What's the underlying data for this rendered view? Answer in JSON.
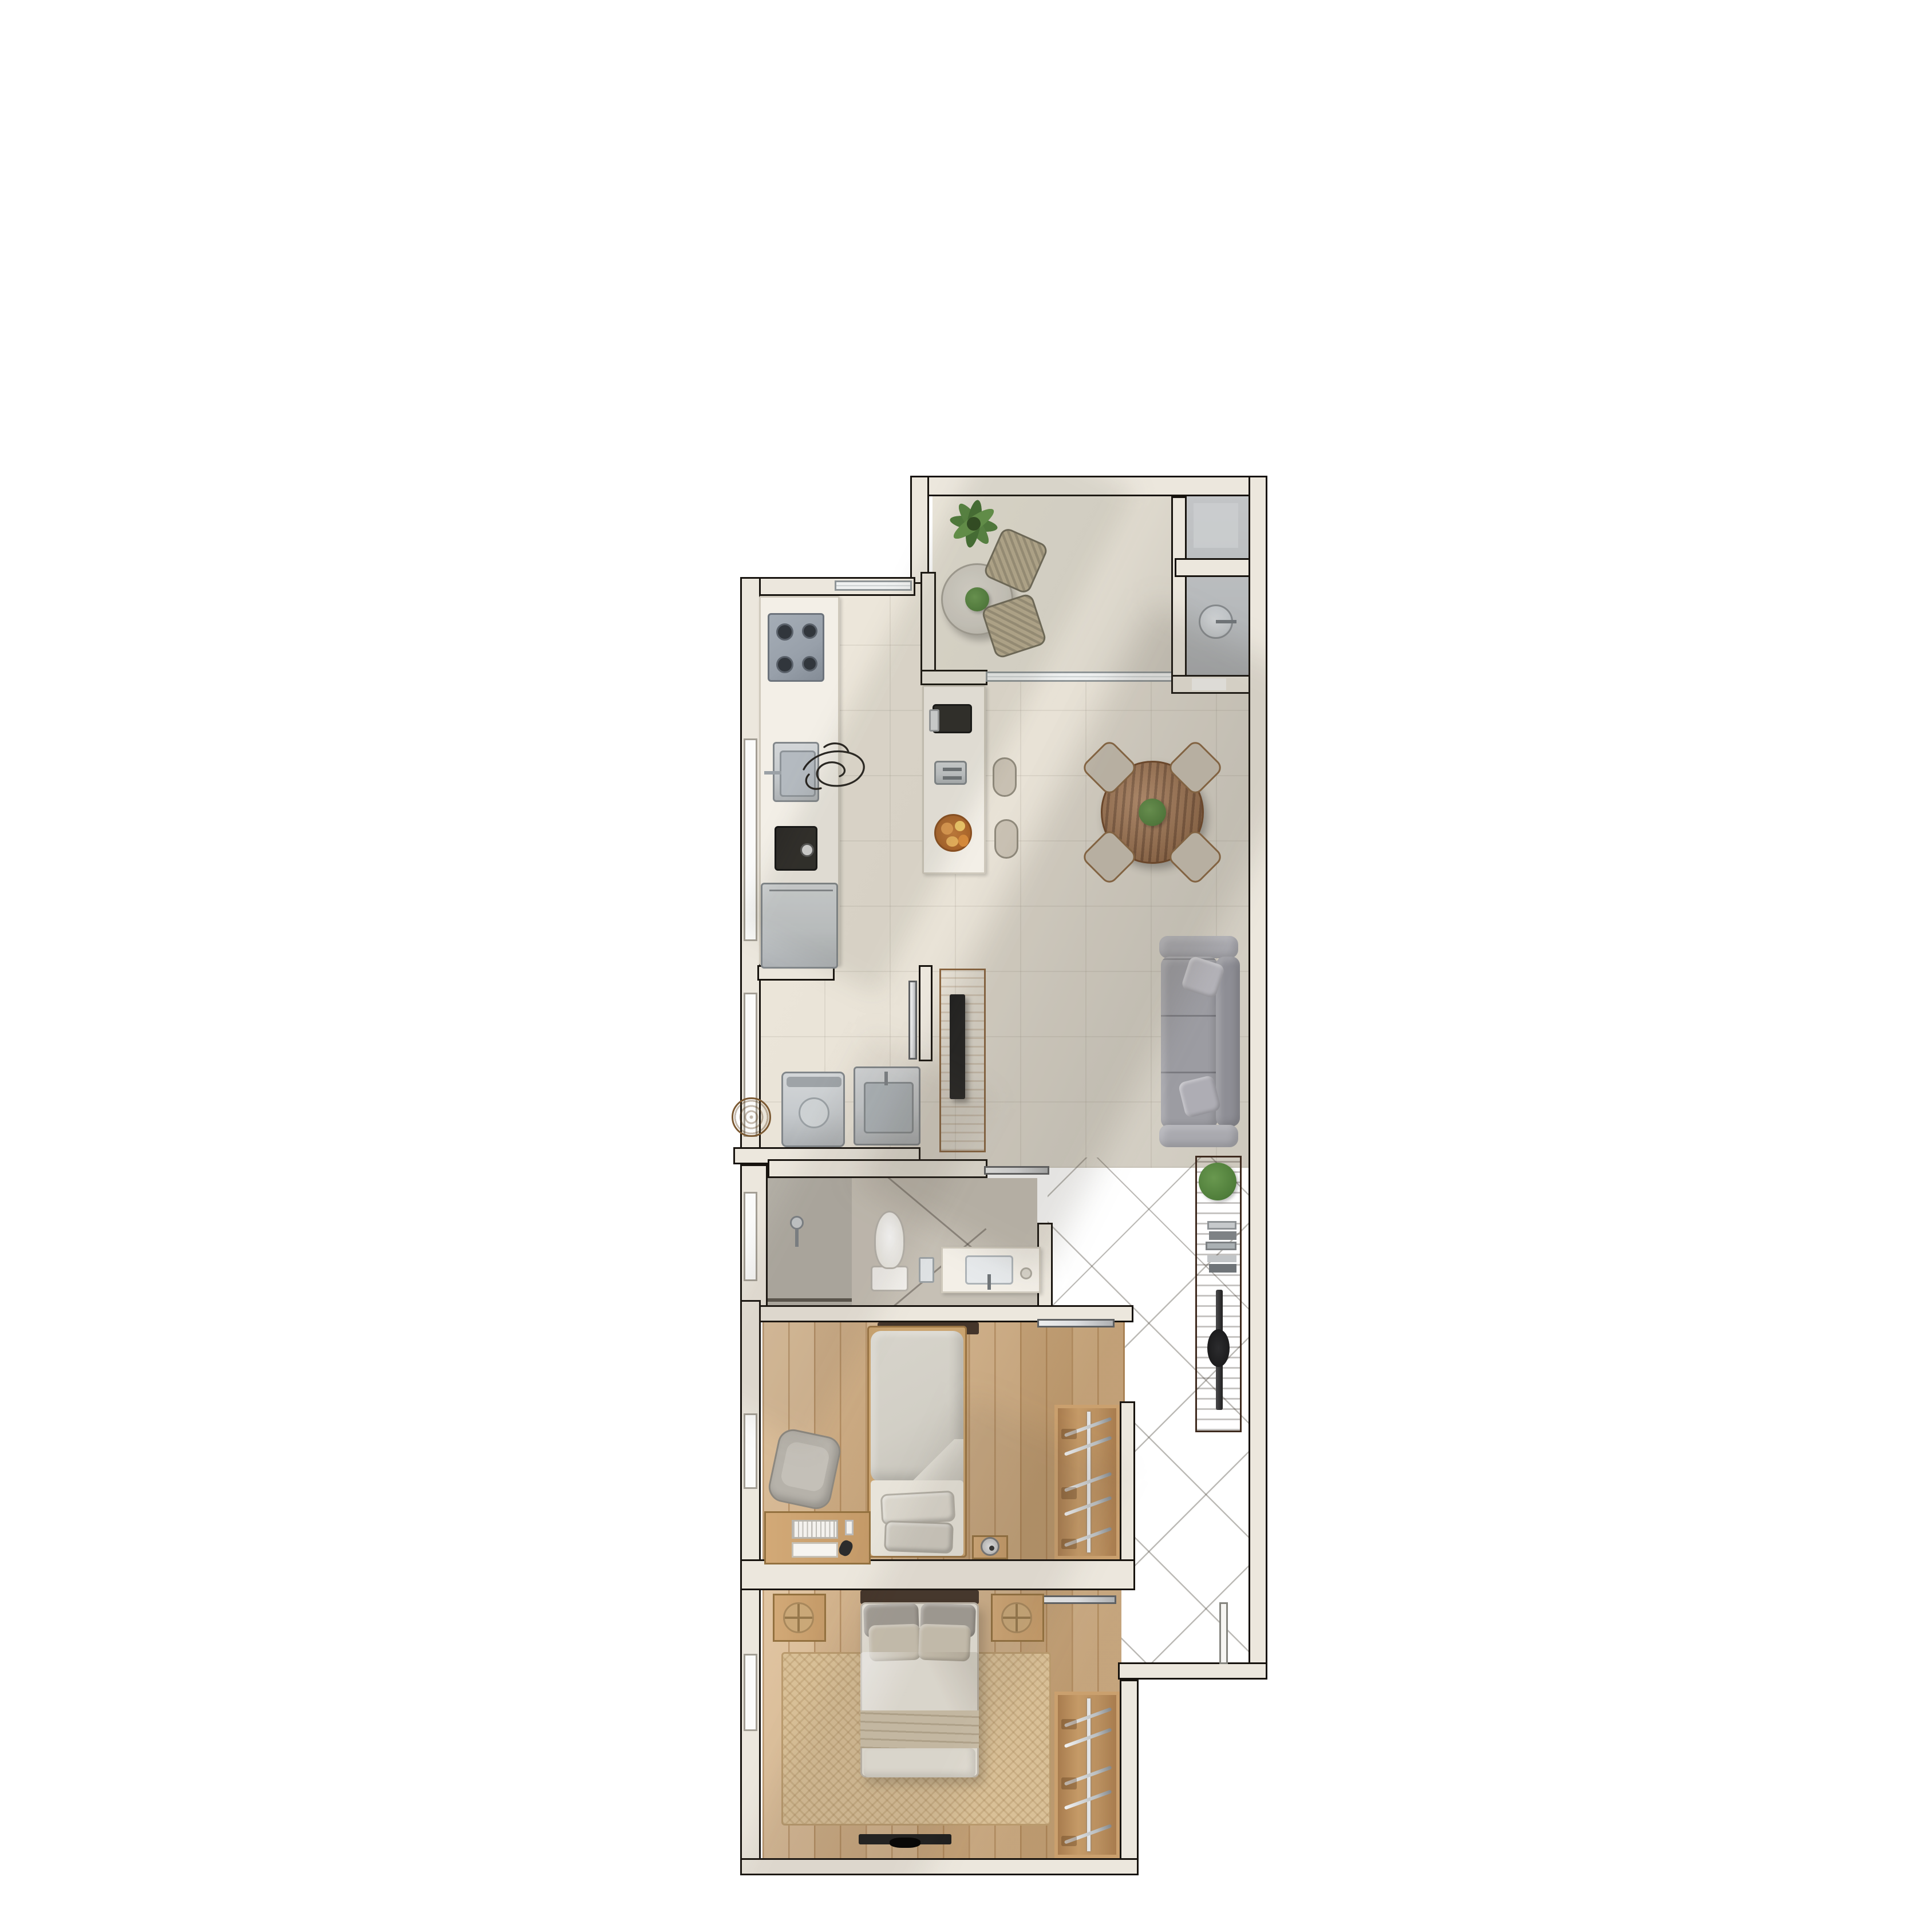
{
  "plan": {
    "type": "apartment-floor-plan-render",
    "view": "top-down",
    "rooms": {
      "terrace": {
        "label": "Terrace",
        "furniture": [
          "palm-plant",
          "bistro-table",
          "terrace-chair",
          "terrace-chair",
          "table-plant"
        ]
      },
      "utility": {
        "label": "Utility room",
        "furniture": [
          "water-heater-tank"
        ]
      },
      "kitchen": {
        "label": "Kitchen",
        "furniture": [
          "gas-cooktop",
          "kitchen-sink",
          "coffee-machine",
          "refrigerator",
          "counter",
          "sketch-figure"
        ]
      },
      "island": {
        "label": "Kitchen island",
        "furniture": [
          "espresso-machine",
          "toaster",
          "fruit-bowl",
          "bar-stool",
          "bar-stool"
        ]
      },
      "dining": {
        "label": "Dining area",
        "furniture": [
          "round-wood-table",
          "dining-chair",
          "dining-chair",
          "dining-chair",
          "dining-chair",
          "centerpiece-plant"
        ]
      },
      "living": {
        "label": "Living area",
        "furniture": [
          "three-seat-sofa",
          "throw-pillow",
          "throw-pillow",
          "sideboard",
          "potted-plant",
          "book-stack",
          "tv-decor"
        ]
      },
      "hall": {
        "label": "Hallway",
        "furniture": [
          "tv-panel",
          "wall-tv"
        ]
      },
      "laundry": {
        "label": "Laundry nook",
        "furniture": [
          "laundry-basket",
          "washing-machine",
          "laundry-sink"
        ]
      },
      "bathroom": {
        "label": "Bathroom",
        "furniture": [
          "shower",
          "toilet",
          "vanity-sink",
          "toothbrush-cup",
          "soap-dish"
        ]
      },
      "bedroom1": {
        "label": "Bedroom 1",
        "furniture": [
          "single-bed",
          "pillows",
          "desk",
          "keyboard",
          "notebook",
          "mouse",
          "desk-chair",
          "nightstand",
          "lamp",
          "open-closet"
        ]
      },
      "bedroom2": {
        "label": "Master bedroom",
        "furniture": [
          "double-bed",
          "headboard",
          "pillows",
          "nightstand",
          "nightstand",
          "woven-tray",
          "woven-tray",
          "jute-rug",
          "wall-tv",
          "open-closet"
        ]
      },
      "entry": {
        "label": "Entry",
        "furniture": [
          "entry-door"
        ]
      }
    },
    "openings": {
      "windows": 5,
      "sliding_glass_door": "terrace-to-living",
      "interior_door_leaves": [
        "laundry-door",
        "bathroom-door",
        "bedroom1-door",
        "bedroom2-door"
      ],
      "entry_door": "bottom-right"
    },
    "palette": {
      "background": "#ffffff",
      "wall_fill": "#ece7dd",
      "wall_line": "#17130e",
      "window": "#fbfbfa",
      "glass": "#eef0f0",
      "floor_main": "#e9e3d7",
      "floor_terrace": "#e4dfd3",
      "floor_utility": "#b7babc",
      "floor_hall": "#cfc9bd",
      "floor_bath": "#c6c0b5",
      "floor_shower": "#b2aea5",
      "wood_floor": "#d3ac7c",
      "wood_floor2": "#d7b182",
      "wood_mid": "#b98f5f",
      "wood_dark": "#64452f",
      "counter_white": "#f3efe7",
      "steel": "#c6cacd",
      "appliance_dark": "#2b2926",
      "sofa_gray": "#9c9ca2",
      "pillow_gray": "#a49f97",
      "pillow_beige": "#cdc5b4",
      "linen_light": "#e8e4da",
      "linen_gray": "#d2cfc6",
      "blanket": "#cfc3ac",
      "headboard_dark": "#44352a",
      "rug_jute": "#d9c097",
      "table_wood": "#9c6740",
      "chair_fabric": "#c9c1b3",
      "chair_frame": "#8a6742",
      "wicker": "#b98f5d",
      "plant_green": "#4f7d3a",
      "plant_light": "#69984f",
      "fruit_orange": "#dd9445",
      "metal_leaf": "#dcdddf",
      "tv_black": "#1e1e1e",
      "door_white": "#f7f6f3"
    }
  }
}
